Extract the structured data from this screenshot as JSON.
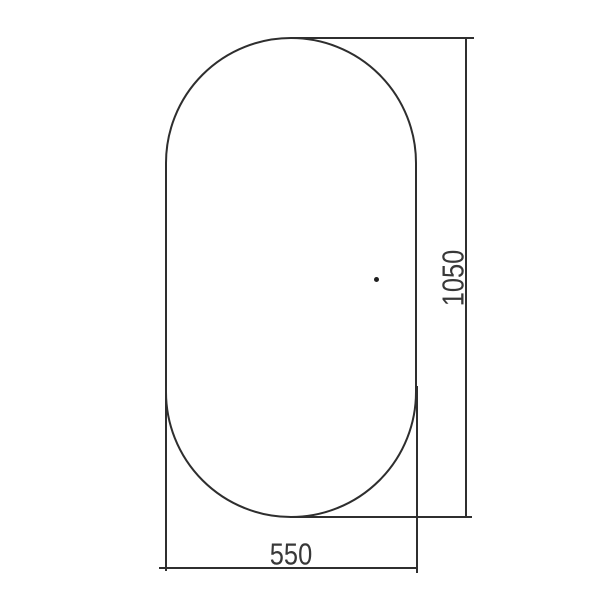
{
  "drawing": {
    "type": "technical-dimension-drawing",
    "shape": "capsule-outline",
    "width_dimension": "550",
    "height_dimension": "1050",
    "colors": {
      "background": "#ffffff",
      "line": "#2f2f2f",
      "text": "#383838",
      "dot": "#1f1f1f"
    }
  }
}
